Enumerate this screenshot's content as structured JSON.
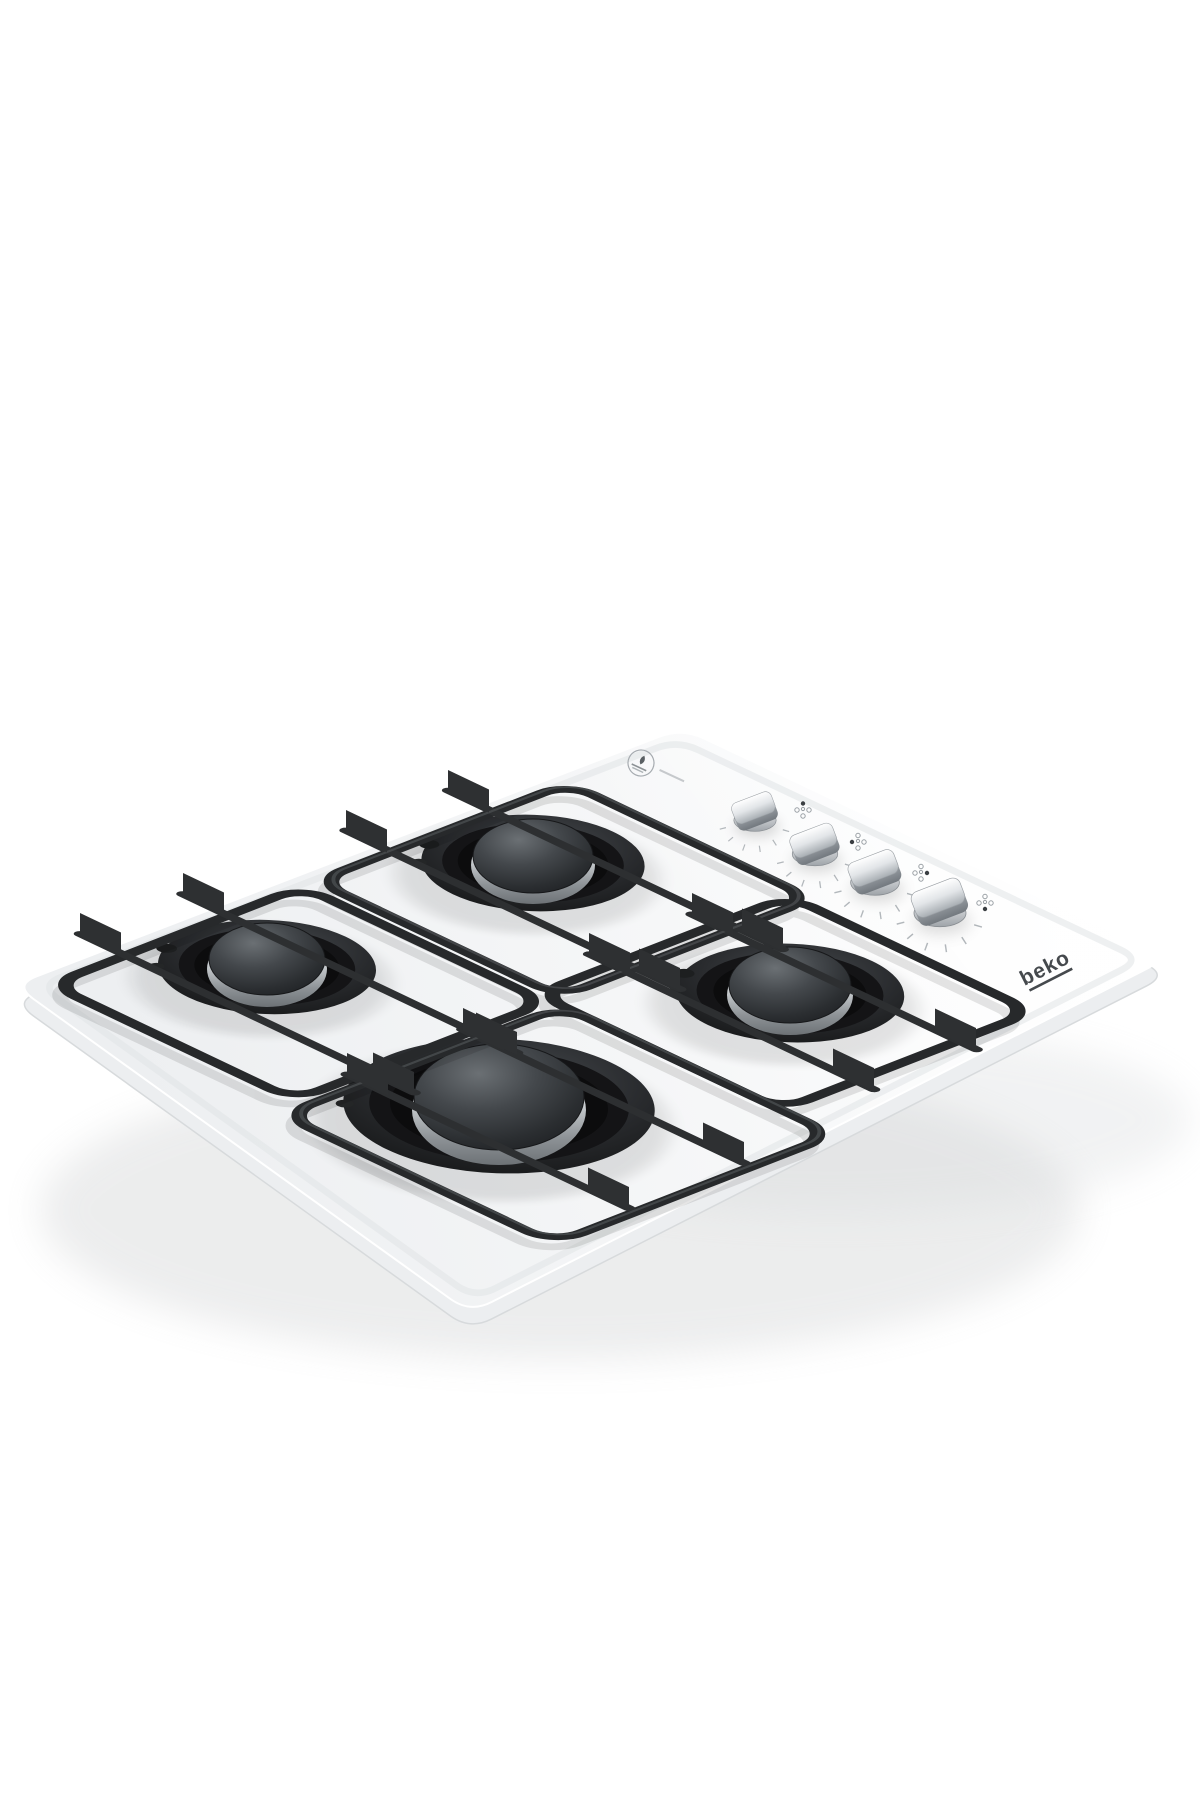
{
  "image": {
    "type": "product-photo",
    "subject": "Built-in 4-burner gas hob with white glass surface, black pan supports and metallic control knobs",
    "view": "three-quarter top perspective",
    "background_color": "#ffffff"
  },
  "brand": {
    "logo_text": "beko",
    "logo_color": "#45494d"
  },
  "hob": {
    "surface": {
      "material": "tempered glass",
      "color": "#f6f7f8",
      "shape": "square panel seen in perspective with rounded corners"
    },
    "burner_count": 4,
    "burners": [
      {
        "id": "back-center",
        "size": "medium",
        "cap_color": "#3a3d40",
        "ring_color": "#c9cdd0"
      },
      {
        "id": "left",
        "size": "medium",
        "cap_color": "#3a3d40",
        "ring_color": "#c9cdd0"
      },
      {
        "id": "right",
        "size": "medium",
        "cap_color": "#3a3d40",
        "ring_color": "#c9cdd0"
      },
      {
        "id": "front-center",
        "size": "large-wok",
        "cap_color": "#34373a",
        "ring_color": "#c9cdd0"
      }
    ],
    "pan_supports": {
      "count": 4,
      "color": "#27292b",
      "style": "square grids with raised vertical finger plates, interlocking bars"
    },
    "knob_count": 4,
    "knobs": [
      {
        "id": "knob-1",
        "controls": "back-center burner",
        "finish": "brushed metal"
      },
      {
        "id": "knob-2",
        "controls": "left burner",
        "finish": "brushed metal"
      },
      {
        "id": "knob-3",
        "controls": "right burner",
        "finish": "brushed metal"
      },
      {
        "id": "knob-4",
        "controls": "front-center burner",
        "finish": "brushed metal"
      }
    ],
    "printed_marks": [
      {
        "name": "efficiency-badge-icon",
        "note": "small circular stamp with flame glyph and illegible micro-print"
      },
      {
        "name": "burner-position-icon",
        "count": 4,
        "note": "dot diagram beside each knob showing which burner it controls"
      },
      {
        "name": "flame-level-scale",
        "count": 4,
        "note": "faint tick arc around each knob"
      }
    ]
  },
  "colors": {
    "support_black": "#27292b",
    "chrome_ring": "#c9cdd0",
    "burner_cap": "#34373a",
    "glass_white": "#f6f7f8",
    "soft_shadow": "#e2e5e7"
  }
}
